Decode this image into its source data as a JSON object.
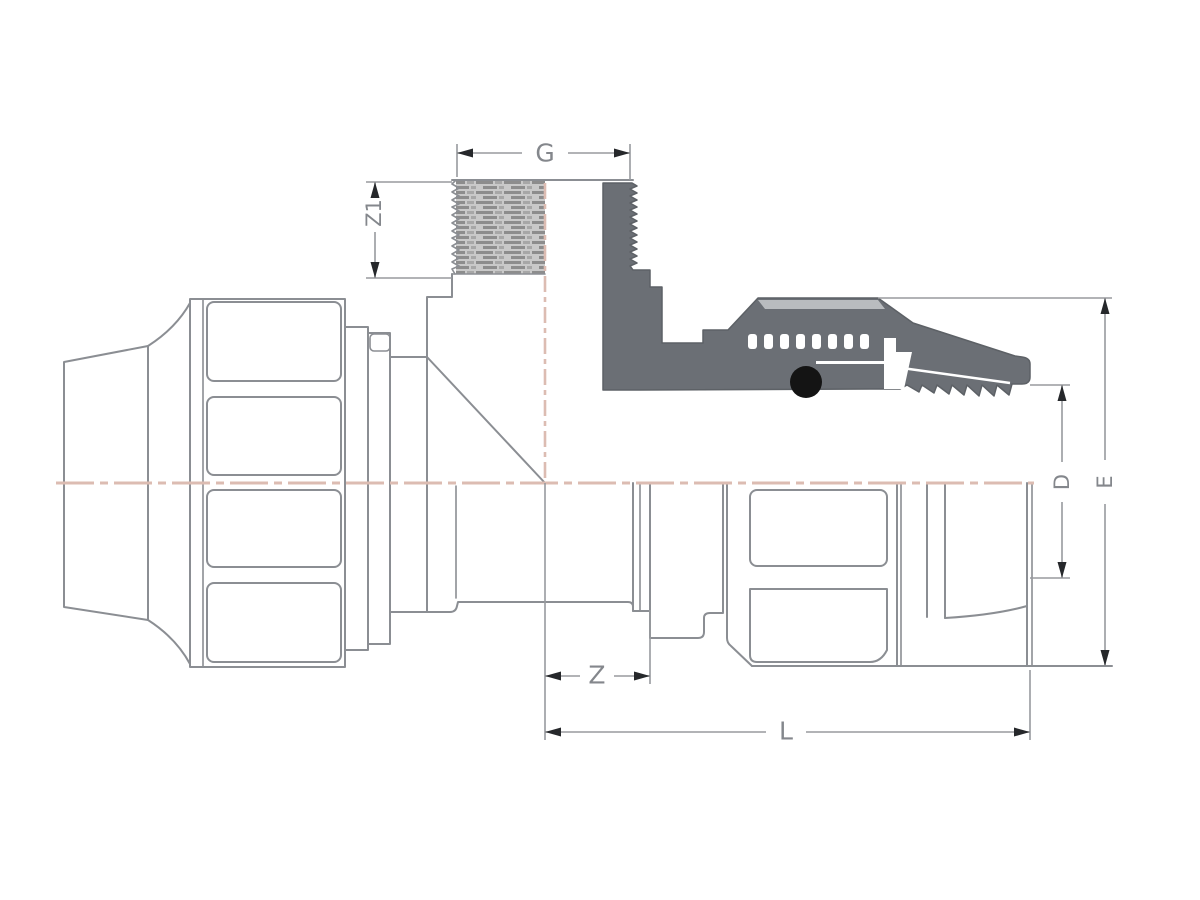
{
  "drawing": {
    "type": "technical-drawing",
    "subject": "compression tee fitting with male threaded branch, half-section view",
    "labels": {
      "g": "G",
      "z1": "Z1",
      "z": "Z",
      "l": "L",
      "d": "D",
      "e": "E"
    },
    "colors": {
      "outline": "#8b8e93",
      "section_fill": "#6b6f75",
      "section_edge": "#5d6166",
      "highlight_stripe": "#b9bcbf",
      "centerline": "#dcbcb2",
      "dimension_line": "#989a9e",
      "arrow": "#26282b",
      "label_text": "#84878c",
      "o_ring": "#141414",
      "thread_base": "#c9c9c9",
      "thread_dash": "#8d8d8d",
      "thread_dash_alt": "#a7a7a7"
    }
  }
}
